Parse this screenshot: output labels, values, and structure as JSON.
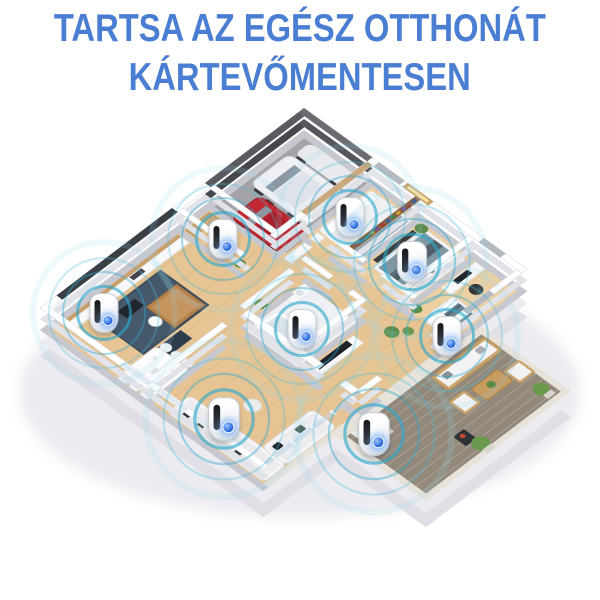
{
  "page": {
    "width": 600,
    "height": 600,
    "background": "#ffffff"
  },
  "header": {
    "title_line1": "TARTSA AZ EGÉSZ OTTHONÁT",
    "title_line2": "KÁRTEVŐMENTESEN",
    "title_color": "#4a7ed2"
  },
  "scene": {
    "description": "Isometric cutaway floor plan of a home; a white plug-in ultrasonic pest repeller with glowing blue LED and teal ultrasonic wave rings is placed in every room",
    "colors": {
      "ring_teal": "#2aa8cc",
      "wood_floor": "#e6c493",
      "wall_white": "#ffffff",
      "wall_side": "#c7c8cf",
      "garage_floor": "#a4a4a8",
      "rug_blue": "#46596c",
      "patio_rug": "#93897b",
      "car_red": "#c12730",
      "car_white": "#eef0f3",
      "plant_green": "#5d8b46",
      "bed_teal": "#8198a4",
      "device_led_blue": "#2e6fe0"
    },
    "rooms": [
      {
        "name": "Garage"
      },
      {
        "name": "Entry hall"
      },
      {
        "name": "Kitchen & living room"
      },
      {
        "name": "Dining area"
      },
      {
        "name": "Bathroom"
      },
      {
        "name": "Lounge"
      },
      {
        "name": "Bedroom"
      },
      {
        "name": "Master bedroom"
      },
      {
        "name": "Home office"
      },
      {
        "name": "Patio"
      }
    ],
    "devices": [
      {
        "room": "Entry hall",
        "x_pct": 37.2,
        "y_pct": 39.9,
        "scale": 1.0
      },
      {
        "room": "Bedroom",
        "x_pct": 58.4,
        "y_pct": 36.2,
        "scale": 1.0
      },
      {
        "room": "Master bedroom",
        "x_pct": 68.6,
        "y_pct": 43.6,
        "scale": 1.05
      },
      {
        "room": "Kitchen & living room",
        "x_pct": 17.3,
        "y_pct": 52.1,
        "scale": 1.0
      },
      {
        "room": "Bathroom",
        "x_pct": 50.3,
        "y_pct": 54.8,
        "scale": 1.0
      },
      {
        "room": "Home office",
        "x_pct": 74.5,
        "y_pct": 56.0,
        "scale": 1.0
      },
      {
        "room": "Lounge",
        "x_pct": 37.3,
        "y_pct": 69.9,
        "scale": 1.1
      },
      {
        "room": "Patio",
        "x_pct": 62.3,
        "y_pct": 72.4,
        "scale": 1.1
      }
    ]
  }
}
